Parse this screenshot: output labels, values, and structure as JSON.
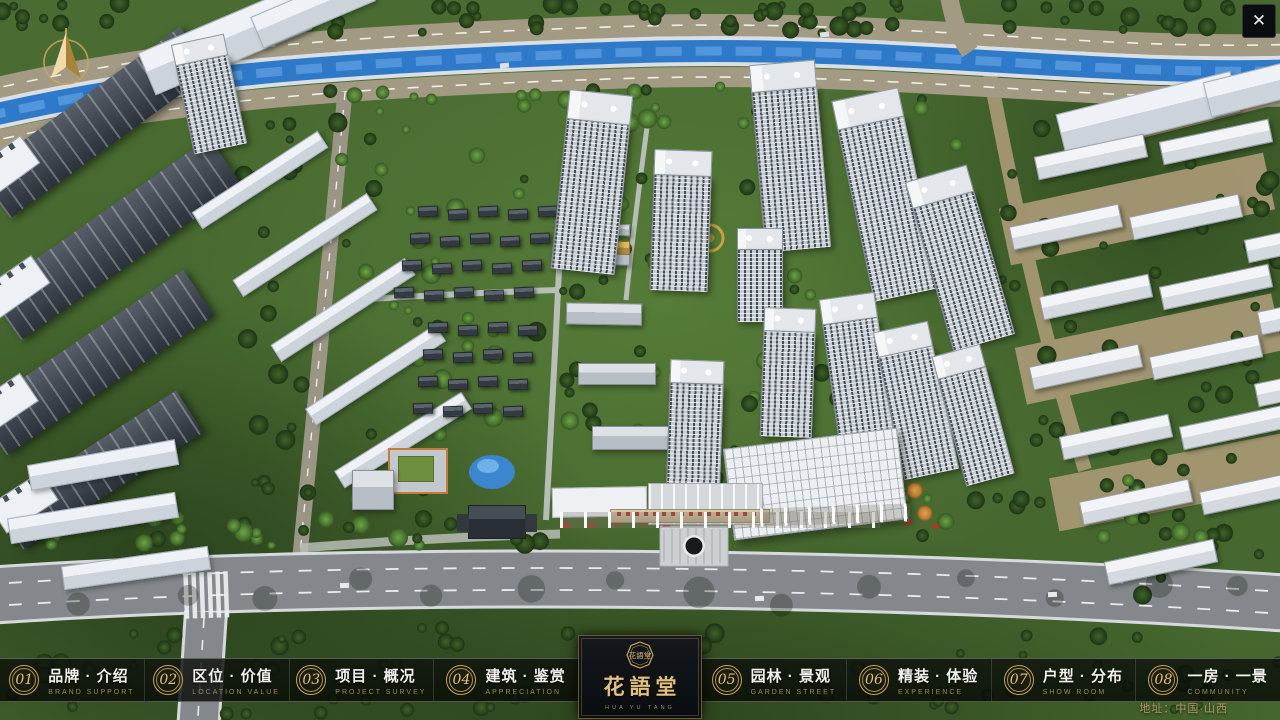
{
  "window": {
    "close_glyph": "✕"
  },
  "nav": {
    "items": [
      {
        "num": "01",
        "cn": "品牌 · 介绍",
        "en": "BRAND SUPPORT"
      },
      {
        "num": "02",
        "cn": "区位 · 价值",
        "en": "LOCATION VALUE"
      },
      {
        "num": "03",
        "cn": "项目 · 概况",
        "en": "PROJECT SURVEY"
      },
      {
        "num": "04",
        "cn": "建筑 · 鉴赏",
        "en": "APPRECIATION"
      },
      {
        "num": "05",
        "cn": "园林 · 景观",
        "en": "GARDEN STREET"
      },
      {
        "num": "06",
        "cn": "精装 · 体验",
        "en": "EXPERIENCE"
      },
      {
        "num": "07",
        "cn": "户型 · 分布",
        "en": "SHOW ROOM"
      },
      {
        "num": "08",
        "cn": "一房 · 一景",
        "en": "COMMUNITY"
      }
    ]
  },
  "logo": {
    "seal_text": "花語堂",
    "cn": "花語堂",
    "en": "HUA YU TANG"
  },
  "footer": {
    "address": "地址：中国·山西"
  },
  "theme": {
    "gold": "#c9a45f",
    "gold-bright": "#e2c17f",
    "gold-dim": "#9c8a5f",
    "cn-text": "#f2f1ec"
  }
}
